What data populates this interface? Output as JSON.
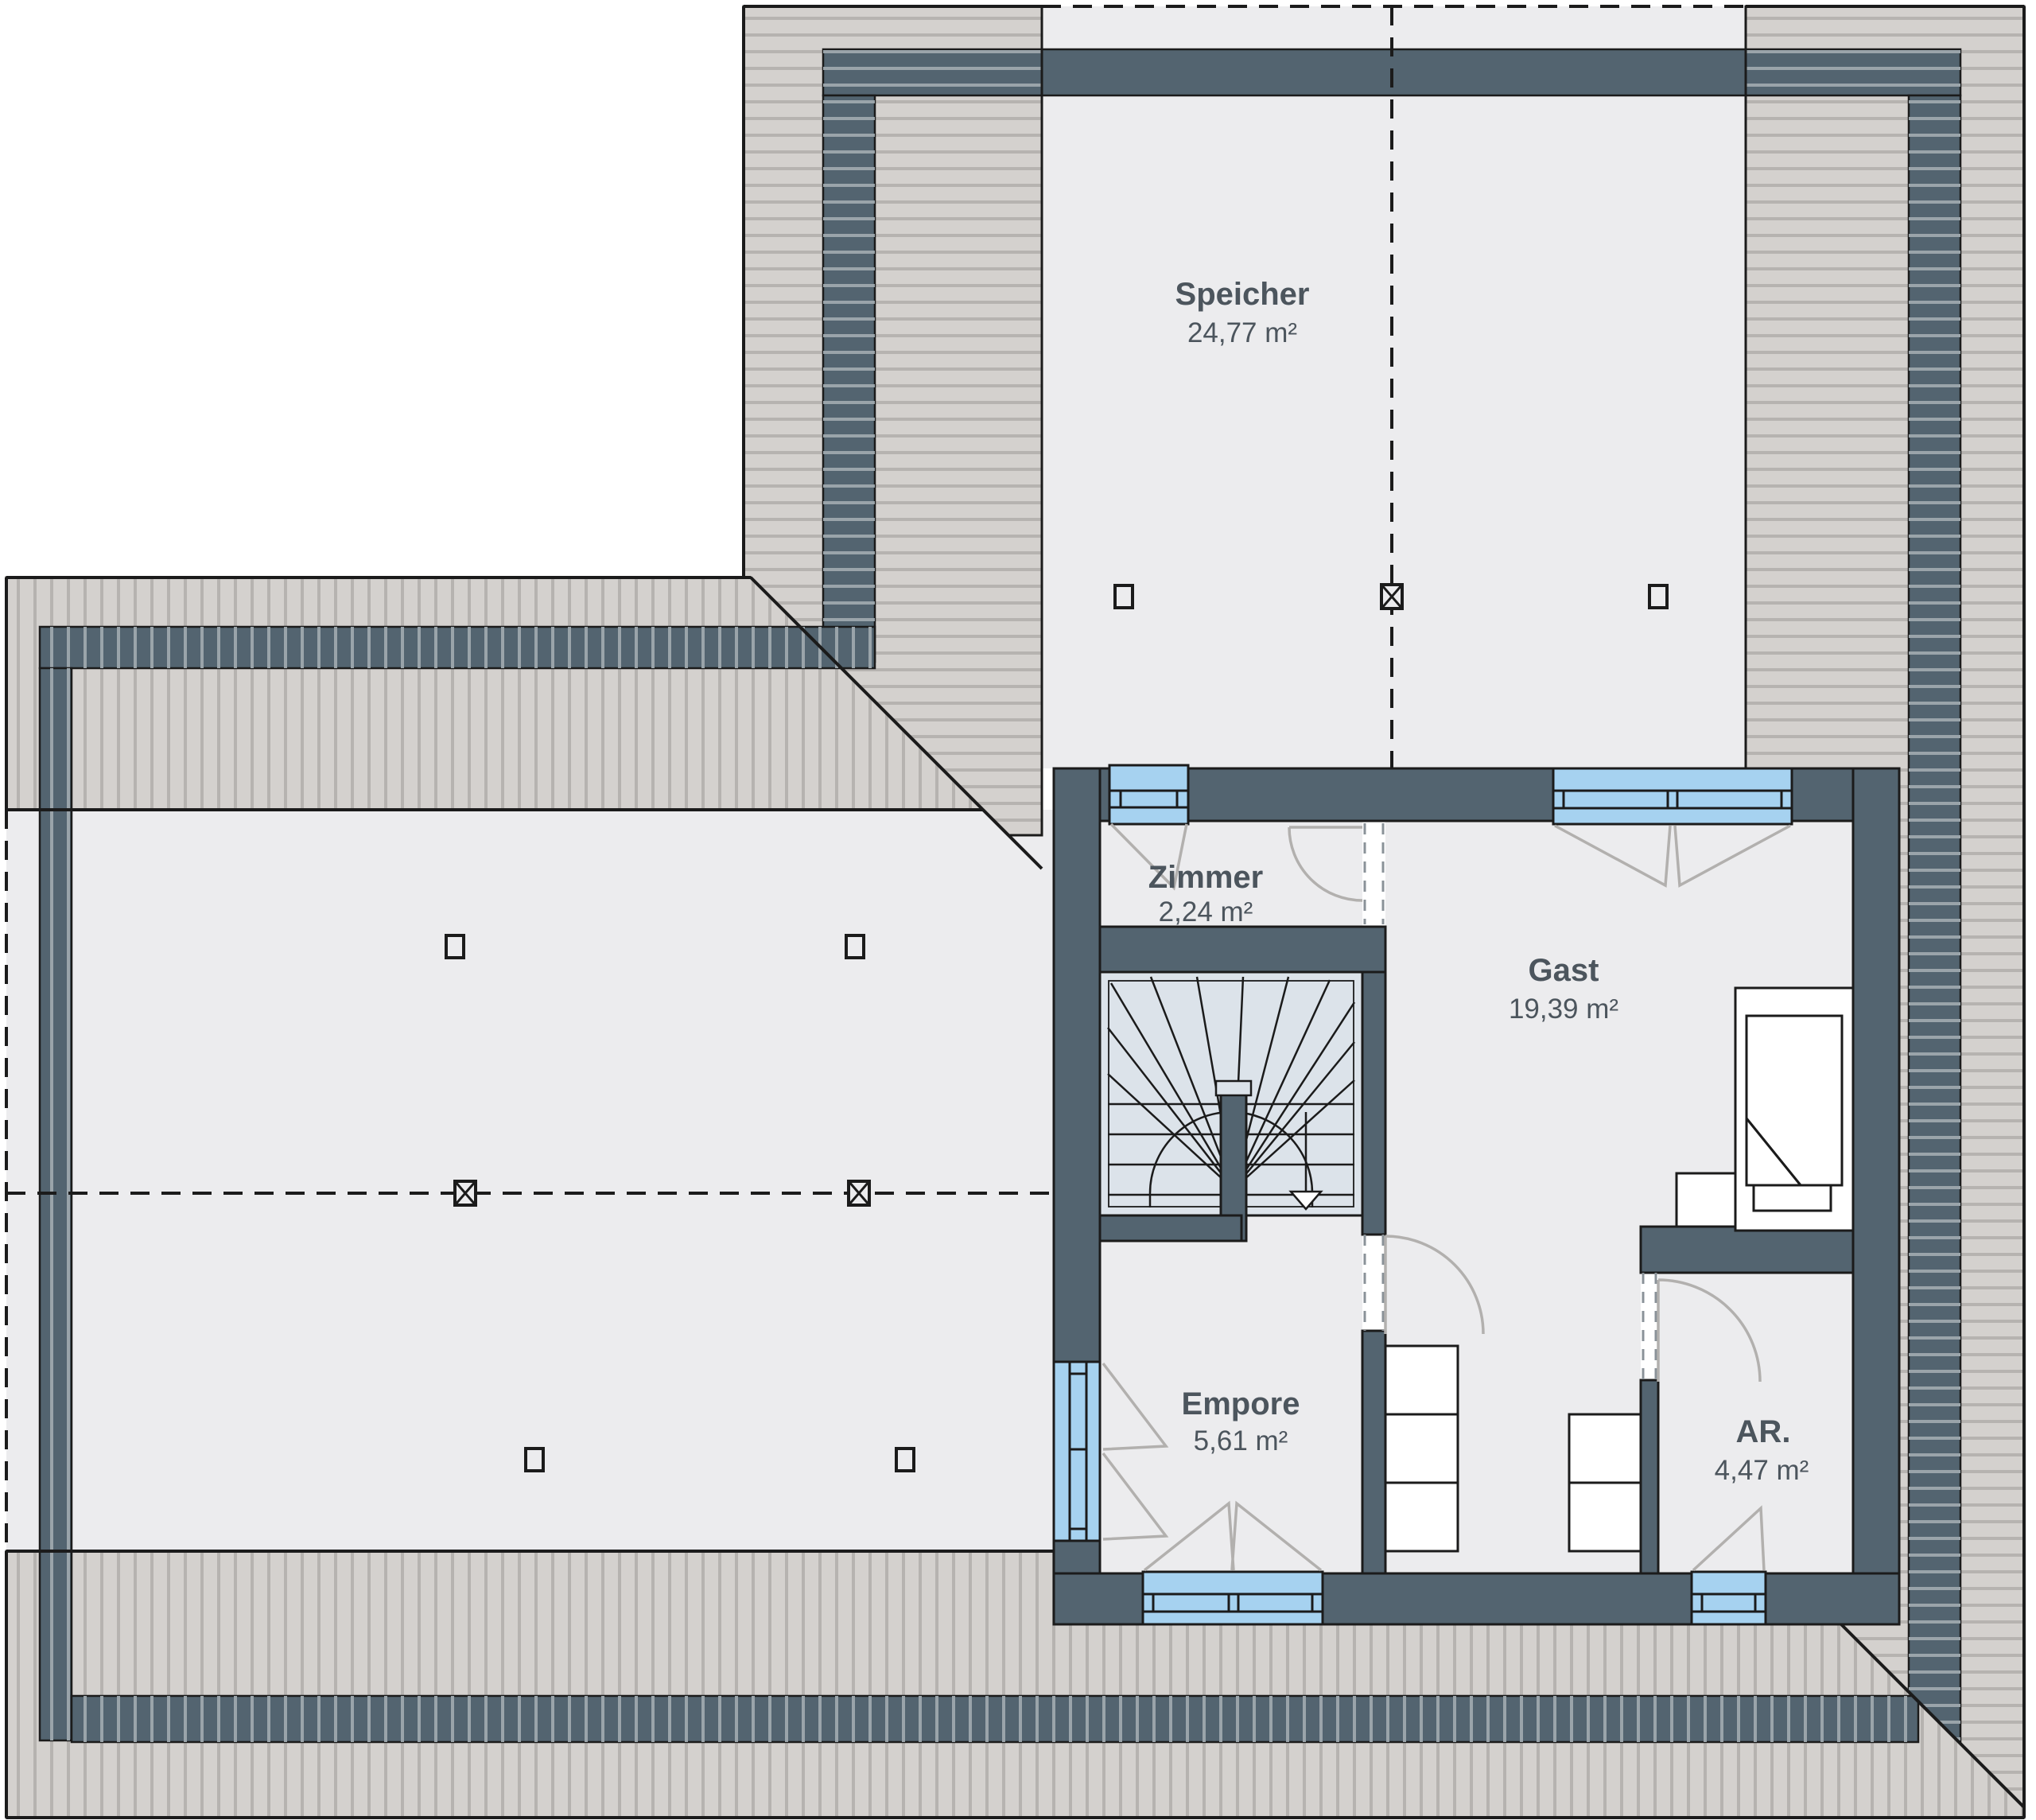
{
  "rooms": {
    "speicher": {
      "name": "Speicher",
      "area": "24,77 m²"
    },
    "zimmer": {
      "name": "Zimmer",
      "area": "2,24 m²"
    },
    "gast": {
      "name": "Gast",
      "area": "19,39 m²"
    },
    "empore": {
      "name": "Empore",
      "area": "5,61 m²"
    },
    "ar": {
      "name": "AR.",
      "area": "4,47 m²"
    }
  },
  "colors": {
    "outside": "#ffffff",
    "wall": "#536470",
    "roof": "#d4d1ce",
    "roof_line": "#b6b3b0",
    "band_line": "#9aa4aa",
    "floor": "#ececee",
    "stair_fill": "#dce3ea",
    "window": "#a6d2f0",
    "door_arc": "#b2b0ae",
    "dash_opening": "#8a9298",
    "text": "#4c555d",
    "outline": "#1b1b1b"
  },
  "symbols": {
    "ridge_post": "crossed-square-post",
    "roof_post": "open-square-post",
    "stair_direction": "down-arrow"
  }
}
